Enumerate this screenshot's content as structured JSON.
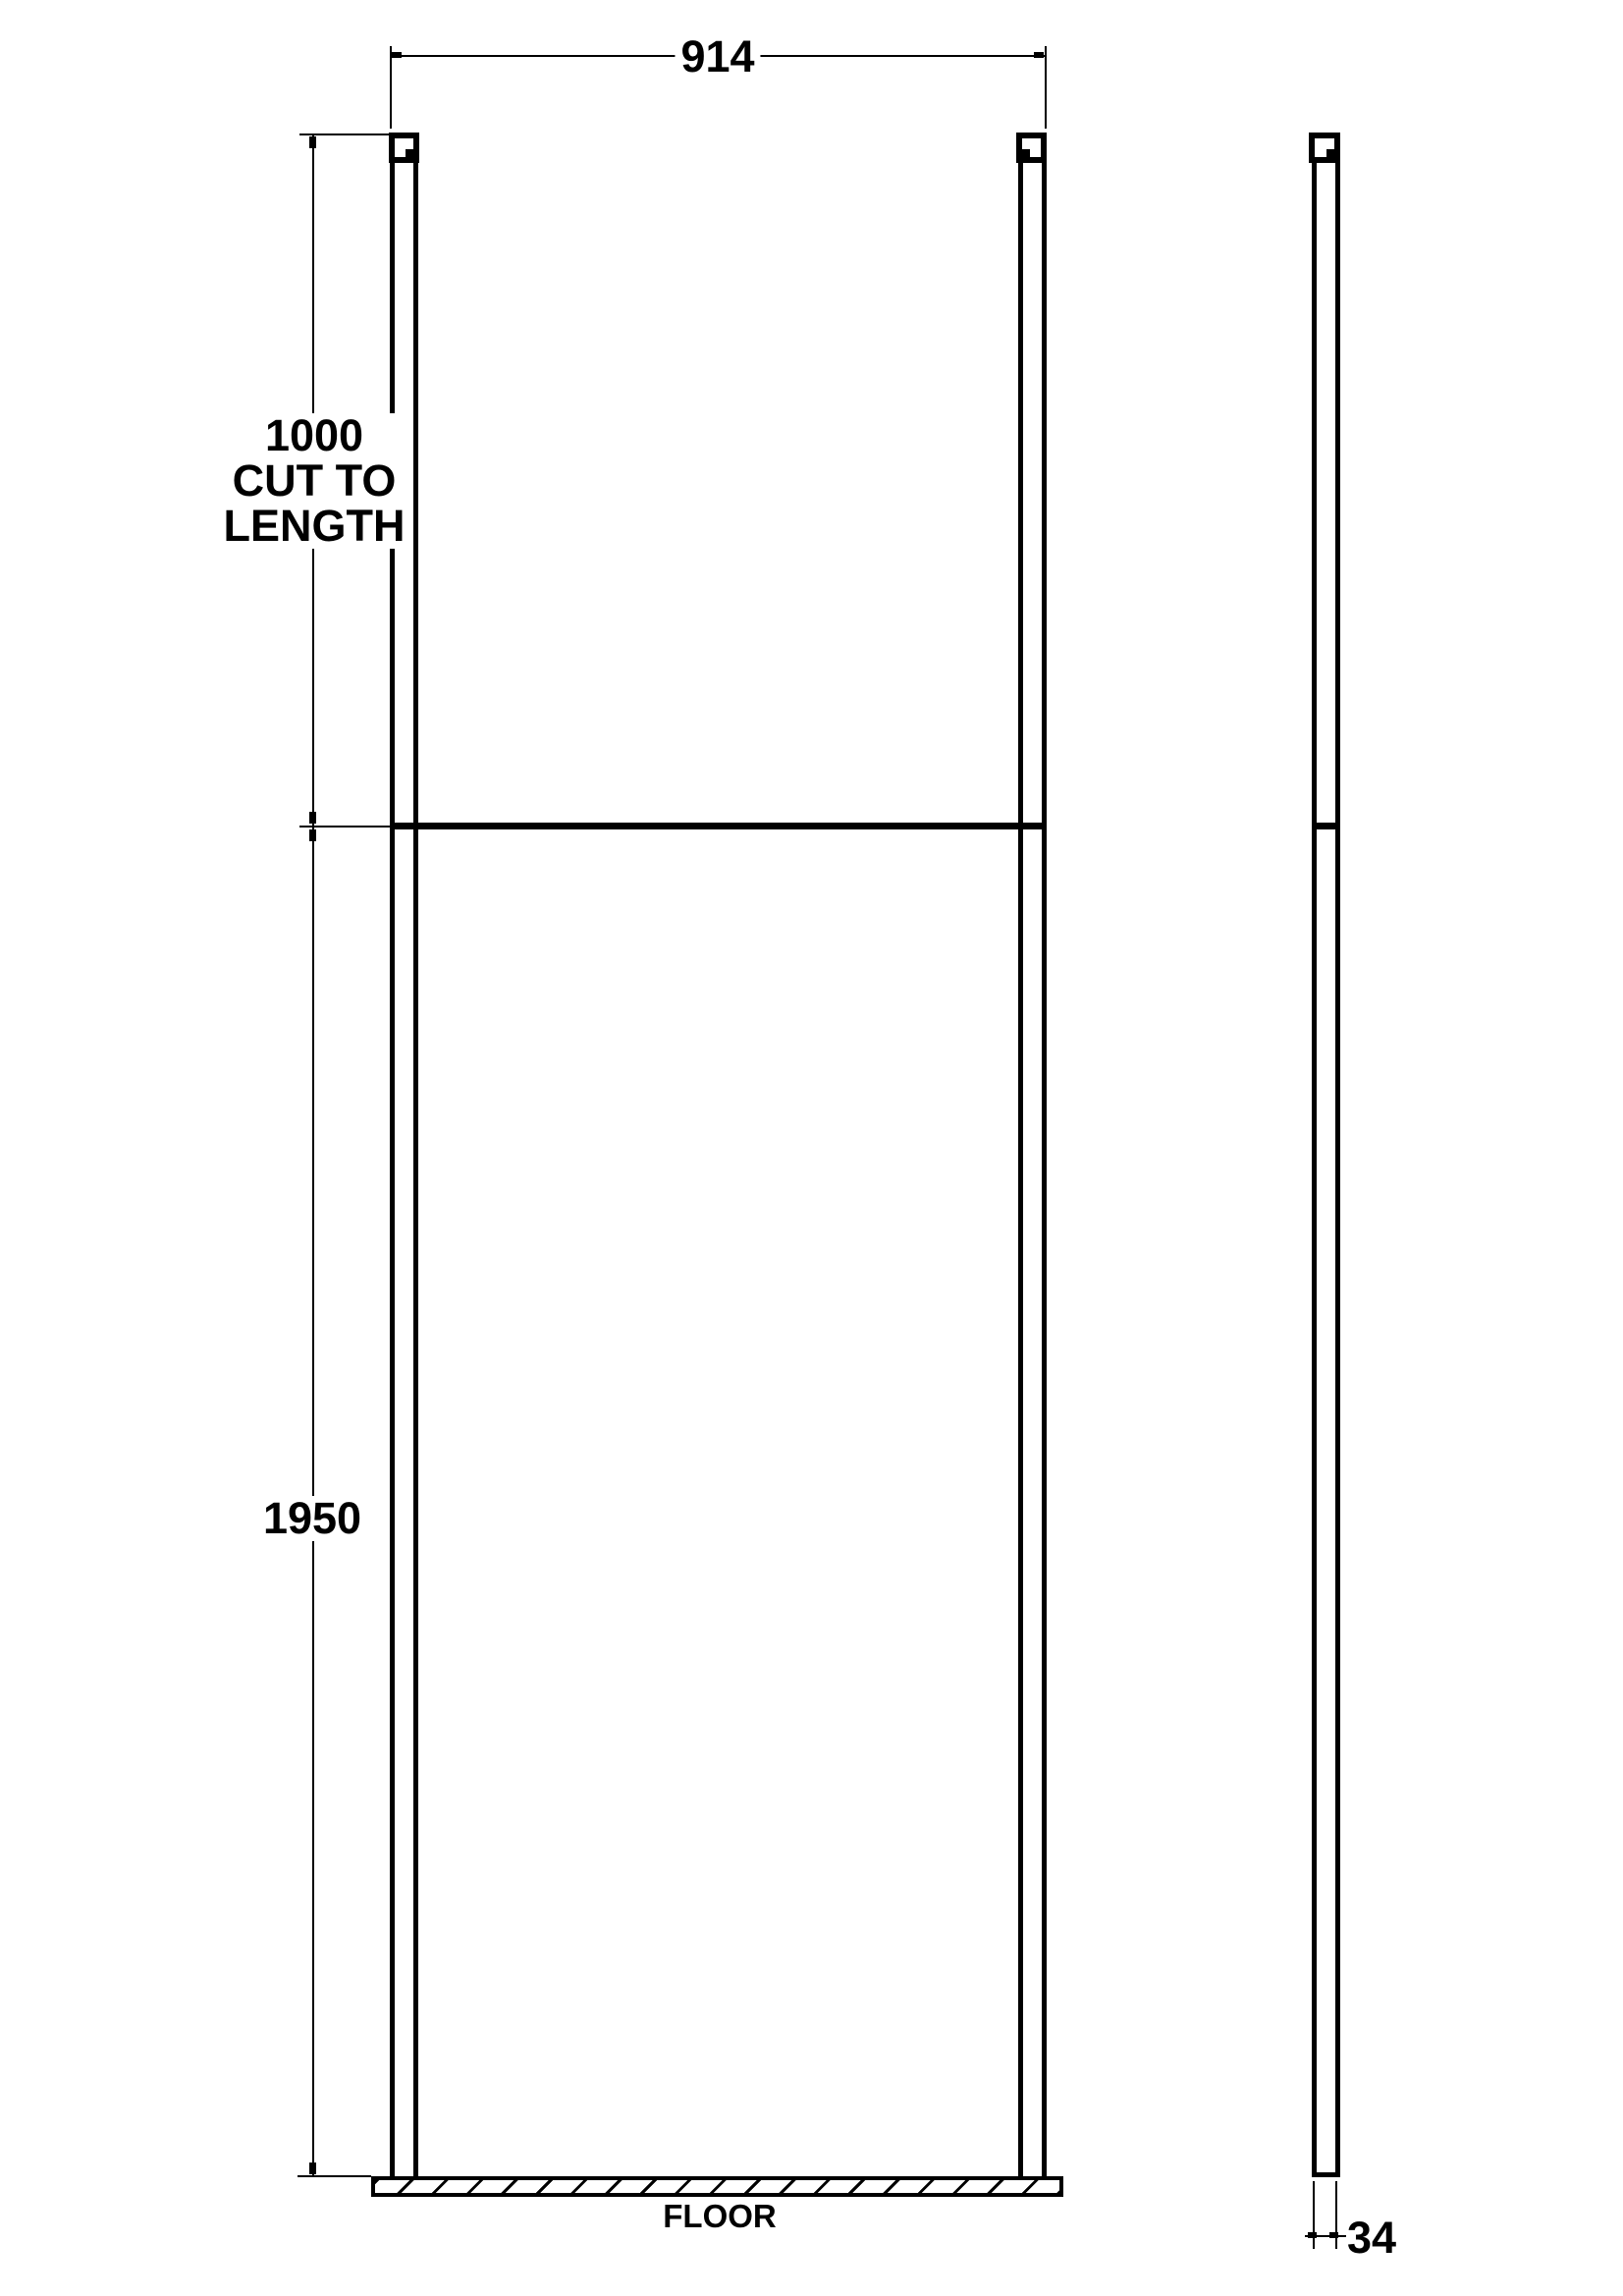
{
  "diagram": {
    "colors": {
      "ink": "#000000",
      "paper": "#ffffff"
    },
    "dimensions": {
      "width": {
        "value": "914"
      },
      "post_drop": {
        "line1": "1000",
        "line2": "CUT TO",
        "line3": "LENGTH"
      },
      "height": {
        "value": "1950"
      },
      "thickness": {
        "value": "34"
      }
    },
    "labels": {
      "floor": "FLOOR"
    }
  }
}
